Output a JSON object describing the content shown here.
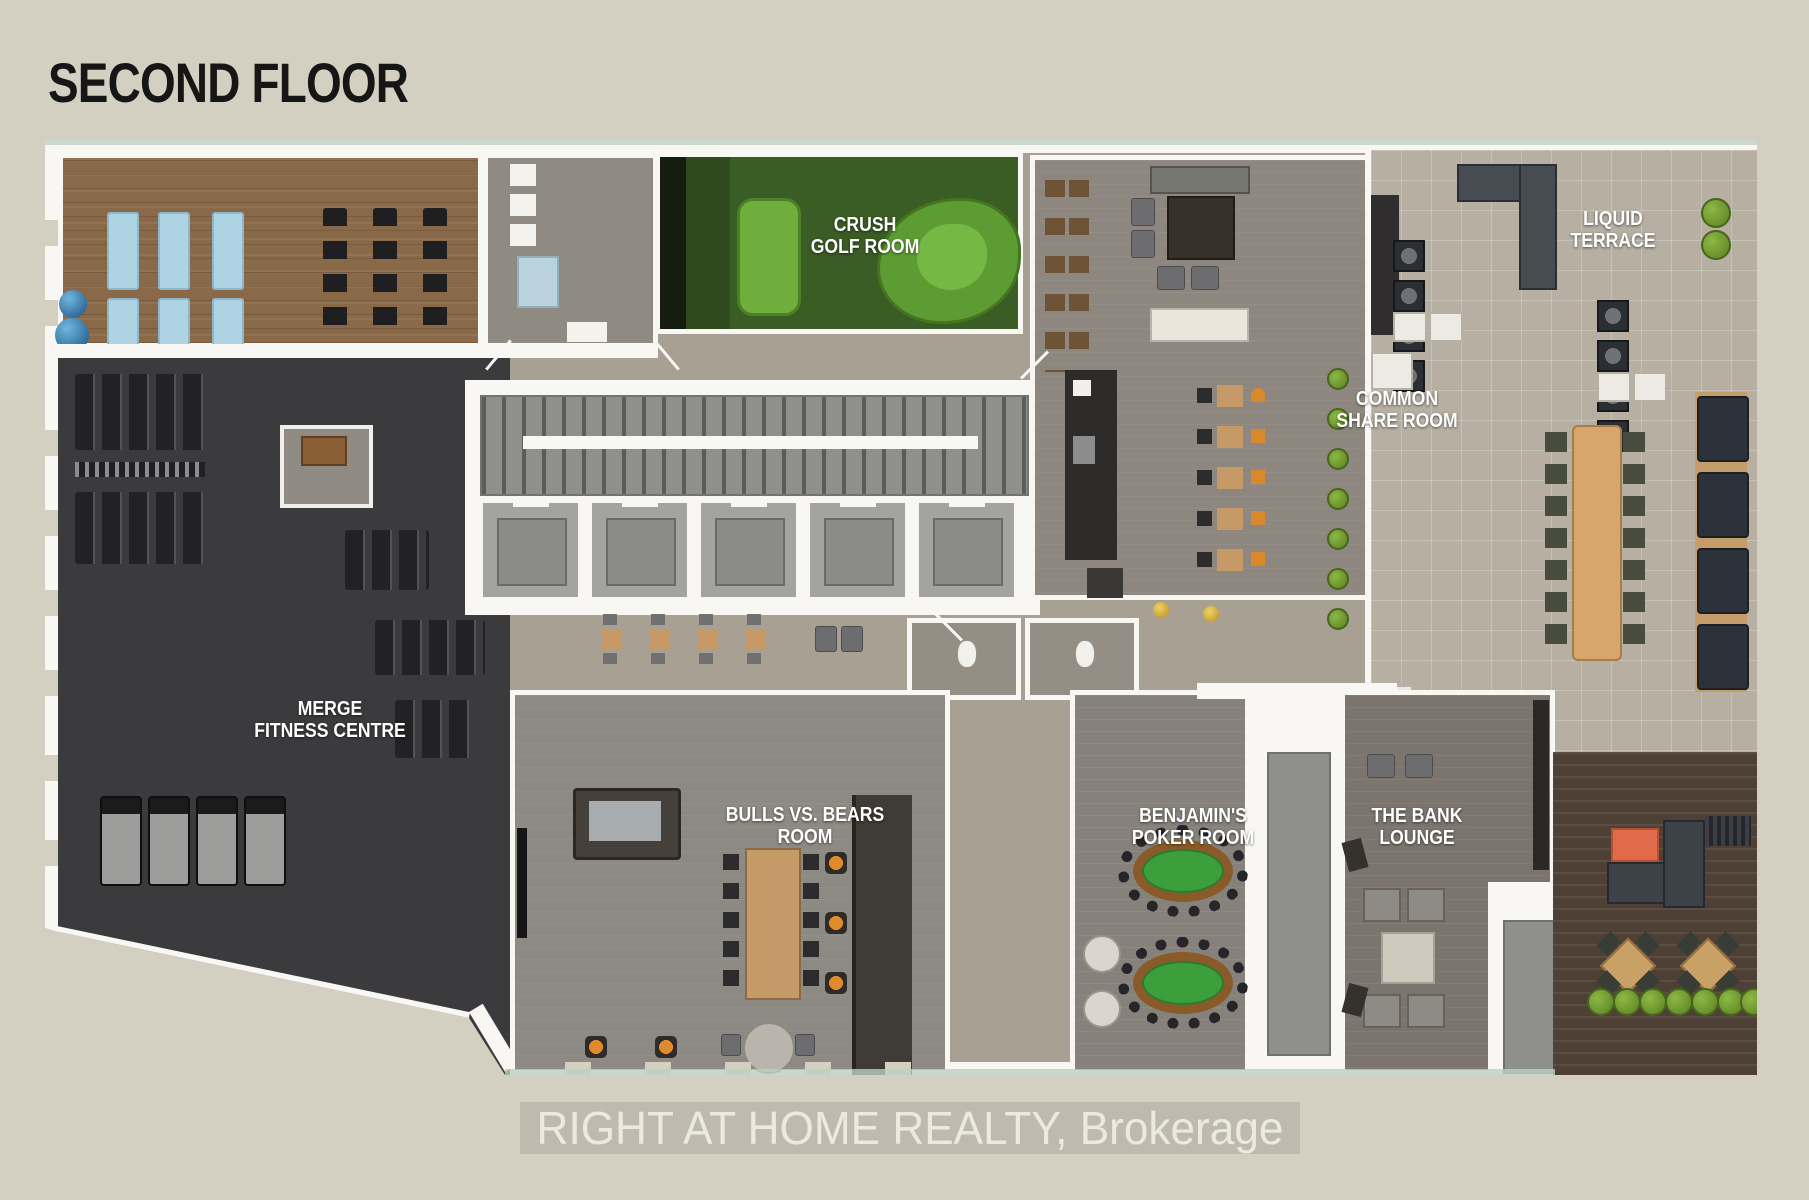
{
  "page": {
    "title": "SECOND FLOOR",
    "watermark": "RIGHT AT HOME REALTY, Brokerage"
  },
  "rooms": {
    "golf": {
      "label": "CRUSH\nGOLF ROOM"
    },
    "share": {
      "label": "COMMON\nSHARE ROOM"
    },
    "terrace": {
      "label": "LIQUID\nTERRACE"
    },
    "fitness": {
      "label": "MERGE\nFITNESS CENTRE"
    },
    "bulls": {
      "label": "BULLS VS. BEARS\nROOM"
    },
    "poker": {
      "label": "BENJAMIN'S\nPOKER ROOM"
    },
    "bank": {
      "label": "THE BANK\nLOUNGE"
    }
  },
  "colors": {
    "background": "#d3d0c2",
    "wall_white": "#f8f7f3",
    "corridor_taupe": "#a8a093",
    "wood_floor": "#8a6948",
    "fitness_dark": "#3b3b3d",
    "golf_green": "#3a5c25",
    "putting_green": "#6fae3c",
    "terrace_tile": "#b6afa2",
    "deck_wood": "#4e4034",
    "poker_felt": "#3ca03a",
    "accent_orange": "#e06a4a",
    "stool_orange": "#e08a2c",
    "mat_blue": "#aed3e3",
    "plant_green": "#6e9a2e"
  }
}
